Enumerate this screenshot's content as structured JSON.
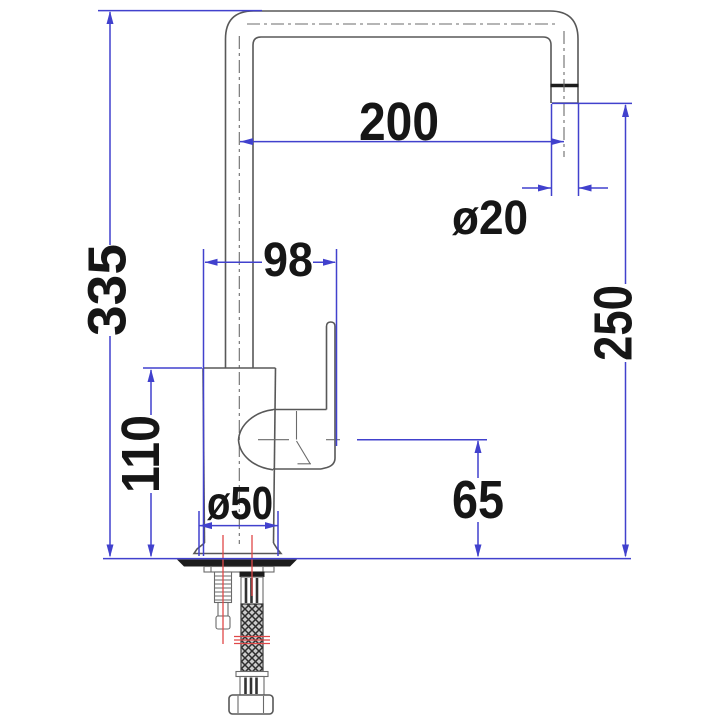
{
  "drawing": {
    "kind": "faucet-dimension-diagram",
    "dims": {
      "overall_height": "335",
      "spout_reach": "200",
      "outlet_diameter": "ø20",
      "outlet_height": "250",
      "body_handle_width": "98",
      "body_height": "110",
      "base_diameter": "ø50",
      "head_clearance": "65"
    },
    "colors": {
      "dimension_blue": "#4141cd",
      "drawing_gray": "#585858",
      "centerline_red": "#e04848",
      "deck_black": "#1c1c1c",
      "label_black": "#161616",
      "background": "#ffffff"
    }
  }
}
